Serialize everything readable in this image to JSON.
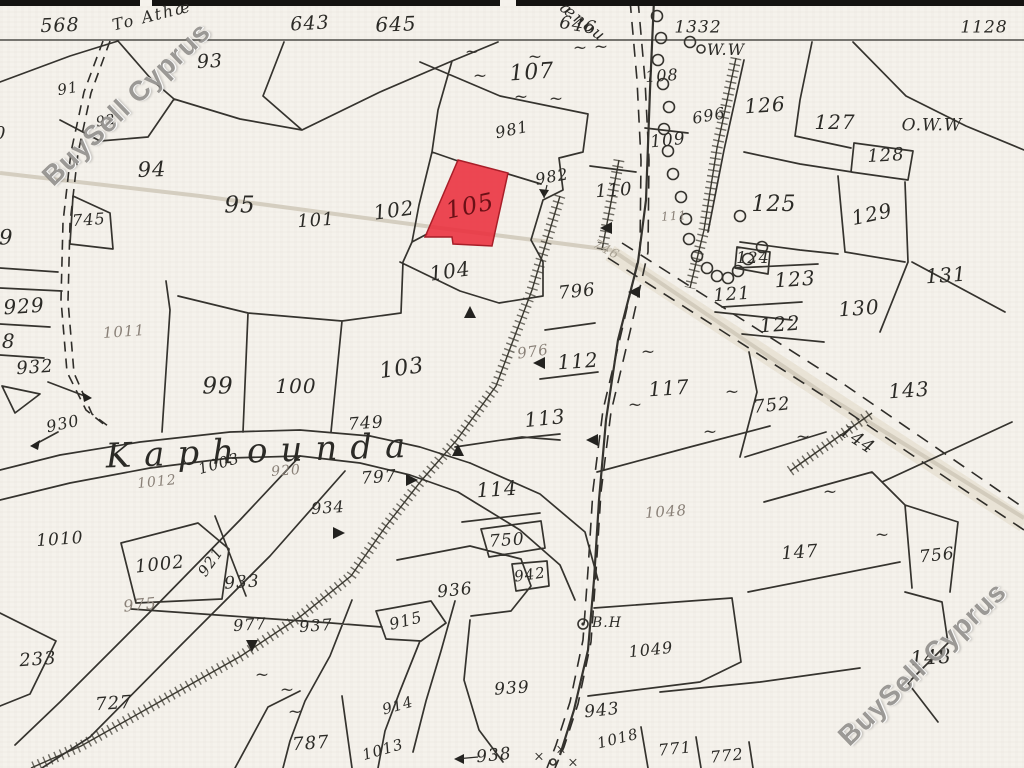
{
  "watermark": {
    "text": "BuySell Cyprus"
  },
  "colors": {
    "ink": "#2b2a26",
    "faded": "#8a8178",
    "ghost": "#a9a294",
    "red_ink": "#6b1016",
    "red_fill": "#ea2f3c",
    "red_stroke": "#a81e28"
  },
  "map": {
    "red_parcel": {
      "number": "105",
      "points": "458,160 508,173 492,246 453,244 452,237 425,237"
    },
    "labels": [
      {
        "t": "568",
        "x": 60,
        "y": 26,
        "r": -2,
        "s": 19
      },
      {
        "t": "To Athæ",
        "x": 152,
        "y": 16,
        "r": -14,
        "s": 16,
        "f": "script"
      },
      {
        "t": "ænou",
        "x": 583,
        "y": 22,
        "r": 38,
        "s": 16,
        "f": "script"
      },
      {
        "t": "643",
        "x": 310,
        "y": 24,
        "r": -3,
        "s": 19
      },
      {
        "t": "645",
        "x": 396,
        "y": 24,
        "r": -2,
        "s": 20
      },
      {
        "t": "646",
        "x": 578,
        "y": 26,
        "r": 10,
        "s": 18
      },
      {
        "t": "1332",
        "x": 698,
        "y": 28,
        "r": 0,
        "s": 17
      },
      {
        "t": "1128",
        "x": 984,
        "y": 28,
        "r": 0,
        "s": 17
      },
      {
        "t": "W.W",
        "x": 726,
        "y": 50,
        "r": 0,
        "s": 16
      },
      {
        "t": "O.W.W",
        "x": 932,
        "y": 126,
        "r": 0,
        "s": 17
      },
      {
        "t": "91",
        "x": 68,
        "y": 89,
        "r": -10,
        "s": 15
      },
      {
        "t": "92",
        "x": 106,
        "y": 121,
        "r": -10,
        "s": 14
      },
      {
        "t": "90",
        "x": -6,
        "y": 134,
        "r": 0,
        "s": 18
      },
      {
        "t": "93",
        "x": 210,
        "y": 62,
        "r": -3,
        "s": 19
      },
      {
        "t": "94",
        "x": 152,
        "y": 170,
        "r": -2,
        "s": 21
      },
      {
        "t": "95",
        "x": 240,
        "y": 206,
        "r": 0,
        "s": 23
      },
      {
        "t": "101",
        "x": 316,
        "y": 221,
        "r": -4,
        "s": 18
      },
      {
        "t": "102",
        "x": 394,
        "y": 210,
        "r": -8,
        "s": 20
      },
      {
        "t": "745",
        "x": 89,
        "y": 220,
        "r": -4,
        "s": 16
      },
      {
        "t": "789",
        "x": -8,
        "y": 238,
        "r": 0,
        "s": 21
      },
      {
        "t": "929",
        "x": 24,
        "y": 306,
        "r": -4,
        "s": 20
      },
      {
        "t": "928",
        "x": -5,
        "y": 341,
        "r": 0,
        "s": 20
      },
      {
        "t": "932",
        "x": 35,
        "y": 368,
        "r": -4,
        "s": 18
      },
      {
        "t": "930",
        "x": 63,
        "y": 424,
        "r": -12,
        "s": 16
      },
      {
        "t": "1011",
        "x": 124,
        "y": 332,
        "r": -4,
        "s": 15,
        "c": "faded"
      },
      {
        "t": "99",
        "x": 218,
        "y": 387,
        "r": 0,
        "s": 23
      },
      {
        "t": "100",
        "x": 296,
        "y": 386,
        "r": 0,
        "s": 20
      },
      {
        "t": "103",
        "x": 402,
        "y": 369,
        "r": -8,
        "s": 22
      },
      {
        "t": "104",
        "x": 450,
        "y": 271,
        "r": -8,
        "s": 20
      },
      {
        "t": "105",
        "x": 470,
        "y": 206,
        "r": -12,
        "s": 24,
        "c": "red_ink"
      },
      {
        "t": "107",
        "x": 532,
        "y": 73,
        "r": -4,
        "s": 22
      },
      {
        "t": "981",
        "x": 512,
        "y": 130,
        "r": -12,
        "s": 16
      },
      {
        "t": "982",
        "x": 552,
        "y": 177,
        "r": -10,
        "s": 16
      },
      {
        "t": "110",
        "x": 614,
        "y": 191,
        "r": -4,
        "s": 18
      },
      {
        "t": "108",
        "x": 662,
        "y": 76,
        "r": -4,
        "s": 16
      },
      {
        "t": "109",
        "x": 668,
        "y": 141,
        "r": -6,
        "s": 17
      },
      {
        "t": "696",
        "x": 709,
        "y": 116,
        "r": -10,
        "s": 16
      },
      {
        "t": "126",
        "x": 765,
        "y": 105,
        "r": -4,
        "s": 20
      },
      {
        "t": "127",
        "x": 835,
        "y": 122,
        "r": 0,
        "s": 20
      },
      {
        "t": "128",
        "x": 886,
        "y": 156,
        "r": -3,
        "s": 18
      },
      {
        "t": "125",
        "x": 774,
        "y": 205,
        "r": 0,
        "s": 22
      },
      {
        "t": "129",
        "x": 872,
        "y": 214,
        "r": -12,
        "s": 20
      },
      {
        "t": "111",
        "x": 674,
        "y": 216,
        "r": -4,
        "s": 12,
        "c": "faded"
      },
      {
        "t": "124",
        "x": 753,
        "y": 258,
        "r": 0,
        "s": 16
      },
      {
        "t": "123",
        "x": 795,
        "y": 279,
        "r": -4,
        "s": 20
      },
      {
        "t": "131",
        "x": 946,
        "y": 275,
        "r": -4,
        "s": 20
      },
      {
        "t": "121",
        "x": 732,
        "y": 295,
        "r": -4,
        "s": 18
      },
      {
        "t": "130",
        "x": 859,
        "y": 308,
        "r": -4,
        "s": 20
      },
      {
        "t": "122",
        "x": 780,
        "y": 324,
        "r": -4,
        "s": 20
      },
      {
        "t": "746",
        "x": 606,
        "y": 250,
        "r": 28,
        "s": 13,
        "c": "ghost"
      },
      {
        "t": "796",
        "x": 577,
        "y": 292,
        "r": -6,
        "s": 18
      },
      {
        "t": "976",
        "x": 533,
        "y": 352,
        "r": -8,
        "s": 15,
        "c": "faded"
      },
      {
        "t": "112",
        "x": 578,
        "y": 361,
        "r": -4,
        "s": 20
      },
      {
        "t": "113",
        "x": 545,
        "y": 418,
        "r": -6,
        "s": 20
      },
      {
        "t": "117",
        "x": 669,
        "y": 388,
        "r": -4,
        "s": 20
      },
      {
        "t": "752",
        "x": 772,
        "y": 406,
        "r": -6,
        "s": 18
      },
      {
        "t": "143",
        "x": 909,
        "y": 390,
        "r": -4,
        "s": 20
      },
      {
        "t": "144",
        "x": 857,
        "y": 440,
        "r": 33,
        "s": 18
      },
      {
        "t": "114",
        "x": 497,
        "y": 489,
        "r": -4,
        "s": 20
      },
      {
        "t": "749",
        "x": 366,
        "y": 424,
        "r": -4,
        "s": 17
      },
      {
        "t": "797",
        "x": 379,
        "y": 478,
        "r": -4,
        "s": 17
      },
      {
        "t": "934",
        "x": 328,
        "y": 508,
        "r": -4,
        "s": 16
      },
      {
        "t": "920",
        "x": 286,
        "y": 471,
        "r": -4,
        "s": 14,
        "c": "faded"
      },
      {
        "t": "1003",
        "x": 219,
        "y": 464,
        "r": -16,
        "s": 15
      },
      {
        "t": "1012",
        "x": 157,
        "y": 482,
        "r": -6,
        "s": 14,
        "c": "faded"
      },
      {
        "t": "Kaphounda",
        "x": 262,
        "y": 451,
        "r": -2,
        "s": 34,
        "f": "place"
      },
      {
        "t": "1010",
        "x": 60,
        "y": 540,
        "r": -4,
        "s": 17
      },
      {
        "t": "1002",
        "x": 160,
        "y": 565,
        "r": -6,
        "s": 18
      },
      {
        "t": "921",
        "x": 211,
        "y": 562,
        "r": -55,
        "s": 15
      },
      {
        "t": "933",
        "x": 242,
        "y": 583,
        "r": -4,
        "s": 17
      },
      {
        "t": "975",
        "x": 140,
        "y": 605,
        "r": -6,
        "s": 16,
        "c": "faded"
      },
      {
        "t": "977",
        "x": 250,
        "y": 625,
        "r": -4,
        "s": 16
      },
      {
        "t": "937",
        "x": 316,
        "y": 626,
        "r": -4,
        "s": 16
      },
      {
        "t": "233",
        "x": 38,
        "y": 660,
        "r": -4,
        "s": 18
      },
      {
        "t": "727",
        "x": 114,
        "y": 704,
        "r": -4,
        "s": 18
      },
      {
        "t": "787",
        "x": 311,
        "y": 744,
        "r": -4,
        "s": 18
      },
      {
        "t": "1013",
        "x": 383,
        "y": 750,
        "r": -16,
        "s": 15
      },
      {
        "t": "914",
        "x": 398,
        "y": 706,
        "r": -16,
        "s": 15
      },
      {
        "t": "915",
        "x": 406,
        "y": 621,
        "r": -14,
        "s": 16
      },
      {
        "t": "936",
        "x": 455,
        "y": 591,
        "r": -6,
        "s": 17
      },
      {
        "t": "942",
        "x": 530,
        "y": 575,
        "r": -8,
        "s": 15
      },
      {
        "t": "750",
        "x": 507,
        "y": 541,
        "r": -4,
        "s": 17
      },
      {
        "t": "939",
        "x": 512,
        "y": 689,
        "r": -4,
        "s": 17
      },
      {
        "t": "938",
        "x": 494,
        "y": 756,
        "r": -6,
        "s": 17
      },
      {
        "t": "943",
        "x": 602,
        "y": 711,
        "r": -6,
        "s": 17
      },
      {
        "t": "1018",
        "x": 618,
        "y": 739,
        "r": -14,
        "s": 15
      },
      {
        "t": "1049",
        "x": 651,
        "y": 650,
        "r": -6,
        "s": 16
      },
      {
        "t": "1048",
        "x": 666,
        "y": 512,
        "r": -4,
        "s": 15,
        "c": "faded"
      },
      {
        "t": "147",
        "x": 800,
        "y": 553,
        "r": -4,
        "s": 18
      },
      {
        "t": "756",
        "x": 937,
        "y": 556,
        "r": -6,
        "s": 17
      },
      {
        "t": "148",
        "x": 931,
        "y": 657,
        "r": -4,
        "s": 20
      },
      {
        "t": "771",
        "x": 675,
        "y": 749,
        "r": -6,
        "s": 16
      },
      {
        "t": "772",
        "x": 727,
        "y": 756,
        "r": -6,
        "s": 16
      },
      {
        "t": "B.H",
        "x": 607,
        "y": 623,
        "r": 0,
        "s": 14
      }
    ],
    "symbols": {
      "tildes": [
        [
          472,
          52
        ],
        [
          535,
          57
        ],
        [
          480,
          76
        ],
        [
          580,
          48
        ],
        [
          601,
          47
        ],
        [
          521,
          97
        ],
        [
          556,
          99
        ],
        [
          648,
          352
        ],
        [
          635,
          405
        ],
        [
          710,
          432
        ],
        [
          732,
          392
        ],
        [
          803,
          437
        ],
        [
          830,
          492
        ],
        [
          882,
          535
        ],
        [
          287,
          690
        ],
        [
          295,
          712
        ],
        [
          262,
          675
        ]
      ],
      "crosses": [
        [
          539,
          757
        ],
        [
          561,
          750
        ],
        [
          573,
          763
        ]
      ],
      "tree_circles": [
        [
          657,
          16
        ],
        [
          661,
          38
        ],
        [
          658,
          60
        ],
        [
          663,
          84
        ],
        [
          669,
          107
        ],
        [
          664,
          129
        ],
        [
          668,
          151
        ],
        [
          673,
          174
        ],
        [
          681,
          197
        ],
        [
          686,
          219
        ],
        [
          689,
          239
        ],
        [
          697,
          256
        ],
        [
          707,
          268
        ],
        [
          717,
          276
        ],
        [
          728,
          278
        ],
        [
          738,
          271
        ],
        [
          748,
          259
        ],
        [
          690,
          42
        ],
        [
          740,
          216
        ],
        [
          762,
          247
        ]
      ]
    }
  }
}
